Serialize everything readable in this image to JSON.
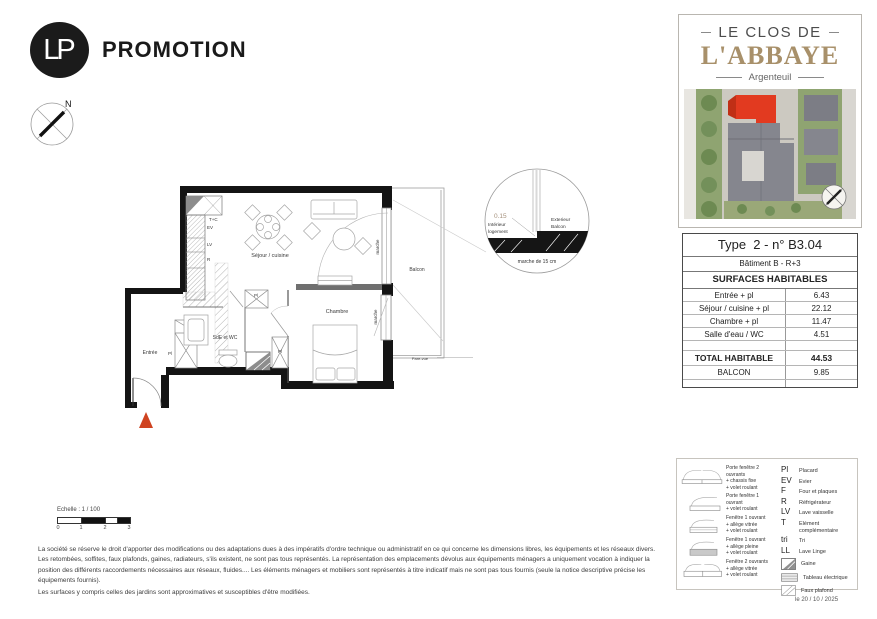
{
  "header": {
    "logo_monogram": "LP",
    "logo_text": "PROMOTION"
  },
  "project_card": {
    "title_line1": "LE CLOS DE",
    "title_line2": "L'ABBAYE",
    "subtitle": "Argenteuil"
  },
  "surface_table": {
    "title": "Type  2 - n° B3.04",
    "building": "Bâtiment B - R+3",
    "section": "SURFACES HABITABLES",
    "rows": [
      {
        "label": "Entrée + pl",
        "value": "6.43"
      },
      {
        "label": "Séjour / cuisine + pl",
        "value": "22.12"
      },
      {
        "label": "Chambre + pl",
        "value": "11.47"
      },
      {
        "label": "Salle d'eau / WC",
        "value": "4.51"
      }
    ],
    "total": {
      "label": "TOTAL HABITABLE",
      "value": "44.53"
    },
    "balcony": {
      "label": "BALCON",
      "value": "9.85"
    }
  },
  "plan": {
    "compass_n": "N",
    "room_sejour": "Séjour / cuisine",
    "room_chambre": "Chambre",
    "room_sde": "SdE et WC",
    "room_entree": "Entrée",
    "balcon": "Balcon",
    "marche": "marche",
    "pare_vue": "Pare-vue",
    "placard": "Pl",
    "kitchen_labels": {
      "tc": "T+C",
      "ev": "EV",
      "lv": "LV",
      "r": "R"
    },
    "detail": {
      "value": "0.15",
      "interior_1": "Intérieur",
      "interior_2": "logement",
      "exterior_1": "Exterieur",
      "exterior_2": "Balcon",
      "caption": "marche de 15 cm"
    }
  },
  "scale_bar": {
    "label": "Echelle : 1 / 100",
    "ticks": [
      "0",
      "1",
      "2",
      "3"
    ]
  },
  "disclaimer": {
    "paragraph1": "La société se réserve le droit d'apporter des modifications ou des adaptations dues à des impératifs d'ordre  technique ou administratif en ce qui concerne les dimensions libres, les équipements et les réseaux divers. Les retombées, soffites, faux plafonds, gaines, radiateurs, s'ils existent, ne sont pas tous représentés. La représentation des emplacements dévolus aux équipements ménagers a uniquement vocation à indiquer la position des différents raccordements nécessaires aux réseaux, fluides.... Les éléments ménagers et mobiliers sont représentés à titre indicatif mais ne sont pas tous fournis (seule la notice descriptive précise les équipements fournis).",
    "paragraph2": "Les surfaces y compris celles des jardins sont approximatives et susceptibles d'être modifiées."
  },
  "legend": {
    "windows": [
      {
        "lines": [
          "Porte fenêtre 2 ouvrants",
          "+ chassis fixe",
          "+ volet roulant"
        ]
      },
      {
        "lines": [
          "Porte fenêtre 1 ouvrant",
          "+ volet roulant"
        ]
      },
      {
        "lines": [
          "Fenêtre 1 ouvrant",
          "+ allège vitrée",
          "+ volet roulant"
        ]
      },
      {
        "lines": [
          "Fenêtre 1 ouvrant",
          "+ allège pleine",
          "+ volet roulant"
        ]
      },
      {
        "lines": [
          "Fenêtre 2 ouvrants",
          "+ allège vitrée",
          "+ volet roulant"
        ]
      }
    ],
    "abbreviations": [
      {
        "abbr": "Pl",
        "label": "Placard"
      },
      {
        "abbr": "EV",
        "label": "Evier"
      },
      {
        "abbr": "F",
        "label": "Four et plaques"
      },
      {
        "abbr": "R",
        "label": "Réfrigérateur"
      },
      {
        "abbr": "LV",
        "label": "Lave vaisselle"
      },
      {
        "abbr": "T",
        "label": "Elément complémentaire"
      },
      {
        "abbr": "tri",
        "label": "Tri"
      },
      {
        "abbr": "LL",
        "label": "Lave Linge"
      }
    ],
    "symbols": [
      {
        "label": "Gaine"
      },
      {
        "label": "Tableau électrique"
      },
      {
        "label": "Faux plafond"
      }
    ]
  },
  "date_label": "le 20 / 10 / 2025",
  "colors": {
    "accent_red": "#cf4320",
    "brand_tan": "#a8906a"
  }
}
